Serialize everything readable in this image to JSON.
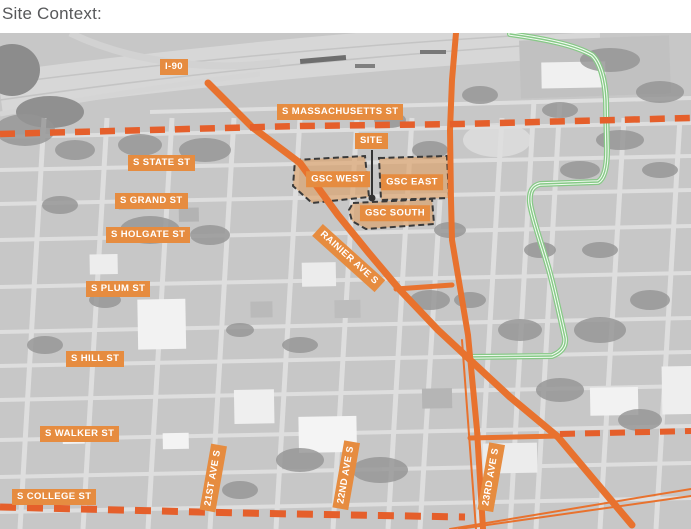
{
  "page": {
    "title": "Site Context:"
  },
  "map": {
    "street_labels": {
      "i90": "I-90",
      "massachusetts": "S MASSACHUSETTS ST",
      "state": "S STATE ST",
      "grand": "S GRAND ST",
      "holgate": "S HOLGATE ST",
      "rainier": "RAINIER AVE S",
      "plum": "S PLUM ST",
      "hill": "S HILL ST",
      "walker": "S WALKER ST",
      "college": "S COLLEGE ST",
      "ave21": "21ST AVE S",
      "ave22": "22ND AVE S",
      "ave23": "23RD AVE S"
    },
    "site_labels": {
      "site": "SITE",
      "gsc_west": "GSC WEST",
      "gsc_east": "GSC EAST",
      "gsc_south": "GSC SOUTH"
    },
    "colors": {
      "road_orange": "#e8722e",
      "label_orange": "#e68c40",
      "boundary_dash_orange": "#e55f2b",
      "site_area_fill": "#dd9d5f",
      "greenway_green": "#86c986",
      "leader_black": "#333333"
    }
  }
}
